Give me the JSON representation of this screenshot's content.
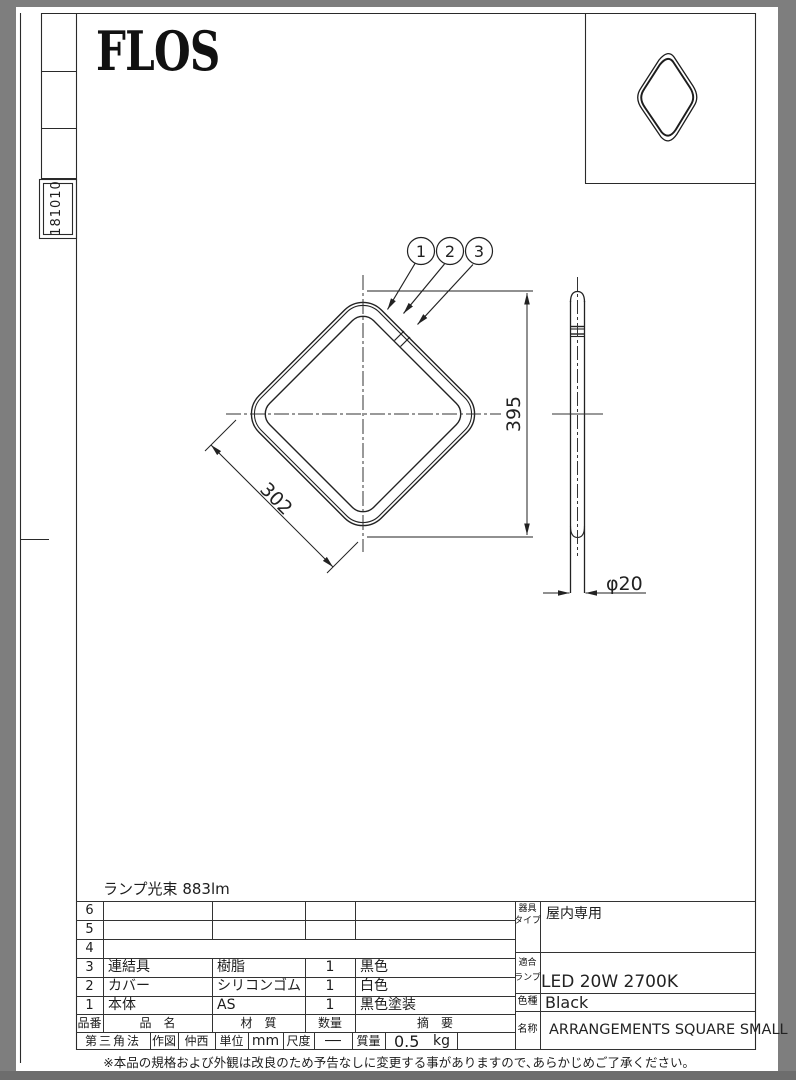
{
  "page": {
    "logo": "FLOS",
    "doc_number": "181010",
    "footer_note": "※本品の規格および外観は改良のため予告なしに変更する事がありますので､あらかじめご了承ください｡"
  },
  "drawing": {
    "lamp_flux_note": "ランプ光束 883lm",
    "callouts": [
      "1",
      "2",
      "3"
    ],
    "dim_side": "302",
    "dim_height": "395",
    "dim_diameter": "φ20"
  },
  "parts_table": {
    "headers": {
      "no": "品番",
      "name": "品　名",
      "material": "材　質",
      "qty": "数量",
      "remark": "摘　要"
    },
    "rows": [
      {
        "no": "6",
        "name": "",
        "material": "",
        "qty": "",
        "remark": ""
      },
      {
        "no": "5",
        "name": "",
        "material": "",
        "qty": "",
        "remark": ""
      },
      {
        "no": "4",
        "name": "",
        "material": "",
        "qty": "",
        "remark": ""
      },
      {
        "no": "3",
        "name": "連結具",
        "material": "樹脂",
        "qty": "1",
        "remark": "黒色"
      },
      {
        "no": "2",
        "name": "カバー",
        "material": "シリコンゴム",
        "qty": "1",
        "remark": "白色"
      },
      {
        "no": "1",
        "name": "本体",
        "material": "AS",
        "qty": "1",
        "remark": "黒色塗装"
      }
    ]
  },
  "title_block": {
    "projection": "第三角法",
    "drawn_label": "作図",
    "drawn_by": "仲西",
    "unit_label": "単位",
    "unit_value": "mm",
    "scale_label": "尺度",
    "scale_value": "──",
    "weight_label": "質量",
    "weight_value": "0.5",
    "weight_unit": "kg"
  },
  "spec_block": {
    "fixture_type_label_1": "器具",
    "fixture_type_label_2": "タイプ",
    "fixture_type_value": "屋内専用",
    "lamp_label_1": "適合",
    "lamp_label_2": "ランプ",
    "lamp_value": "LED 20W 2700K",
    "color_label": "色種",
    "color_value": "Black",
    "name_label": "名称",
    "name_value": "ARRANGEMENTS SQUARE SMALL"
  }
}
